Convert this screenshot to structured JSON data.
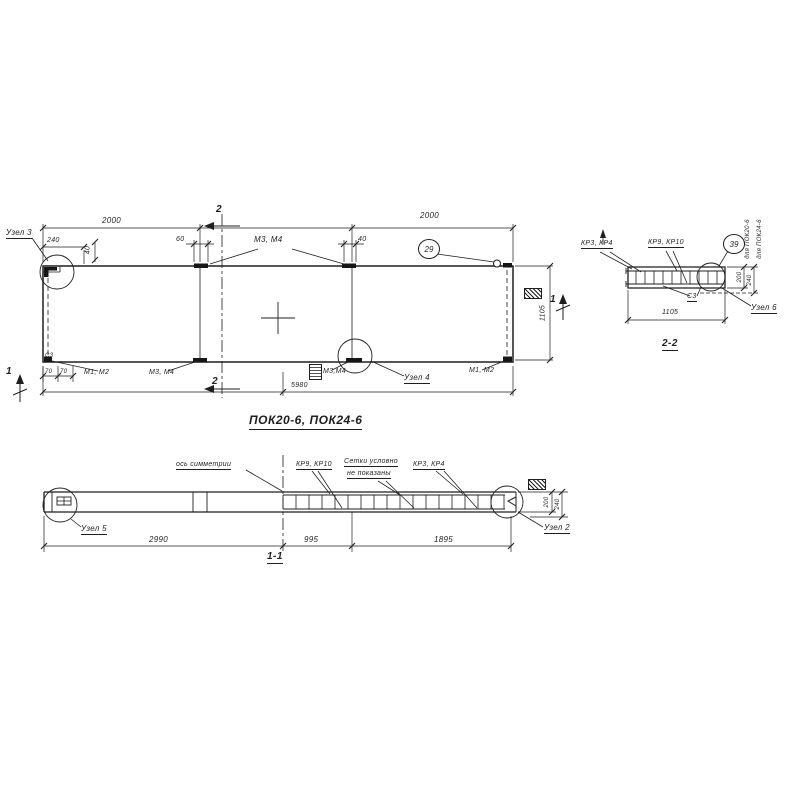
{
  "paper": {
    "background": "#ffffff",
    "ink": "#1f1f1f"
  },
  "plan": {
    "title": "ПОК20-6, ПОК24-6",
    "labels": {
      "uzel3": "Узел 3",
      "m3m4_top": "М3, М4",
      "callout29": "29",
      "m1m2_left": "М1, М2",
      "m3m4_left": "М3, М4",
      "m3m4_mid": "М3,М4",
      "uzel4": "Узел 4",
      "m1m2_right": "М1, М2",
      "c3": "С3"
    },
    "dims": {
      "top_left": "2000",
      "top_right": "2000",
      "corner": "240",
      "step": "40",
      "seam_left": "60",
      "seam_right": "40",
      "height": "1105",
      "total": "5980",
      "edge1": "70",
      "edge2": "70"
    },
    "marks": {
      "s1": "1",
      "s2": "2"
    }
  },
  "section22": {
    "title": "2-2",
    "labels": {
      "kr34": "КР3, КР4",
      "kr910": "КР9, КР10",
      "c3": "С3",
      "uzel6": "Узел 6",
      "callout39": "39",
      "pok20": "для ПОК20-6",
      "pok24": "для ПОК24-6"
    },
    "dims": {
      "t200": "200",
      "t240": "240",
      "width": "1105"
    }
  },
  "section11": {
    "title": "1-1",
    "labels": {
      "axis": "ось симметрии",
      "kr910": "КР9, КР10",
      "note_line1": "Сетки условно",
      "note_line2": "не показаны",
      "kr34": "КР3, КР4",
      "uzel5": "Узел 5",
      "uzel2": "Узел 2"
    },
    "dims": {
      "left": "2990",
      "mid": "995",
      "right": "1895",
      "t200": "200",
      "t240": "240"
    }
  }
}
